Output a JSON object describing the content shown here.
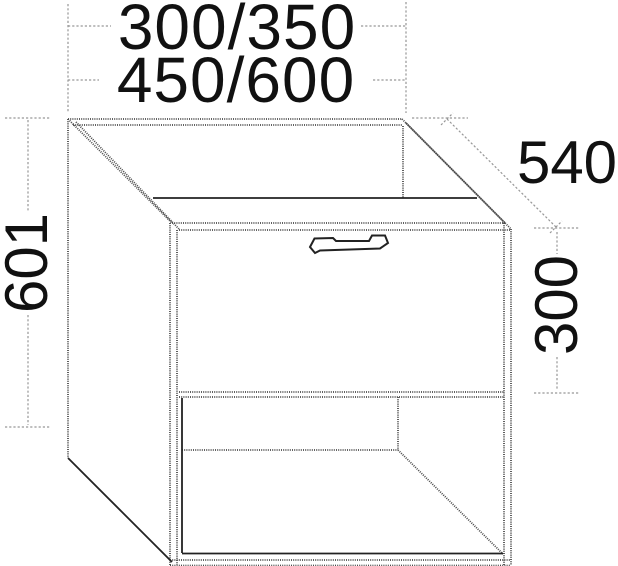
{
  "figure": {
    "type": "technical-drawing",
    "subject": "washbasin base cabinet with drawer and open shelf",
    "background": "#ffffff",
    "colors": {
      "edge_line": "#4a4a4a",
      "interior_line": "#222222",
      "dimension_line": "#979797",
      "text": "#111111"
    },
    "dimensions": {
      "width_options_top": "300/350",
      "width_options_bottom": "450/600",
      "depth": "540",
      "height": "601",
      "drawer_front_height": "300"
    }
  }
}
